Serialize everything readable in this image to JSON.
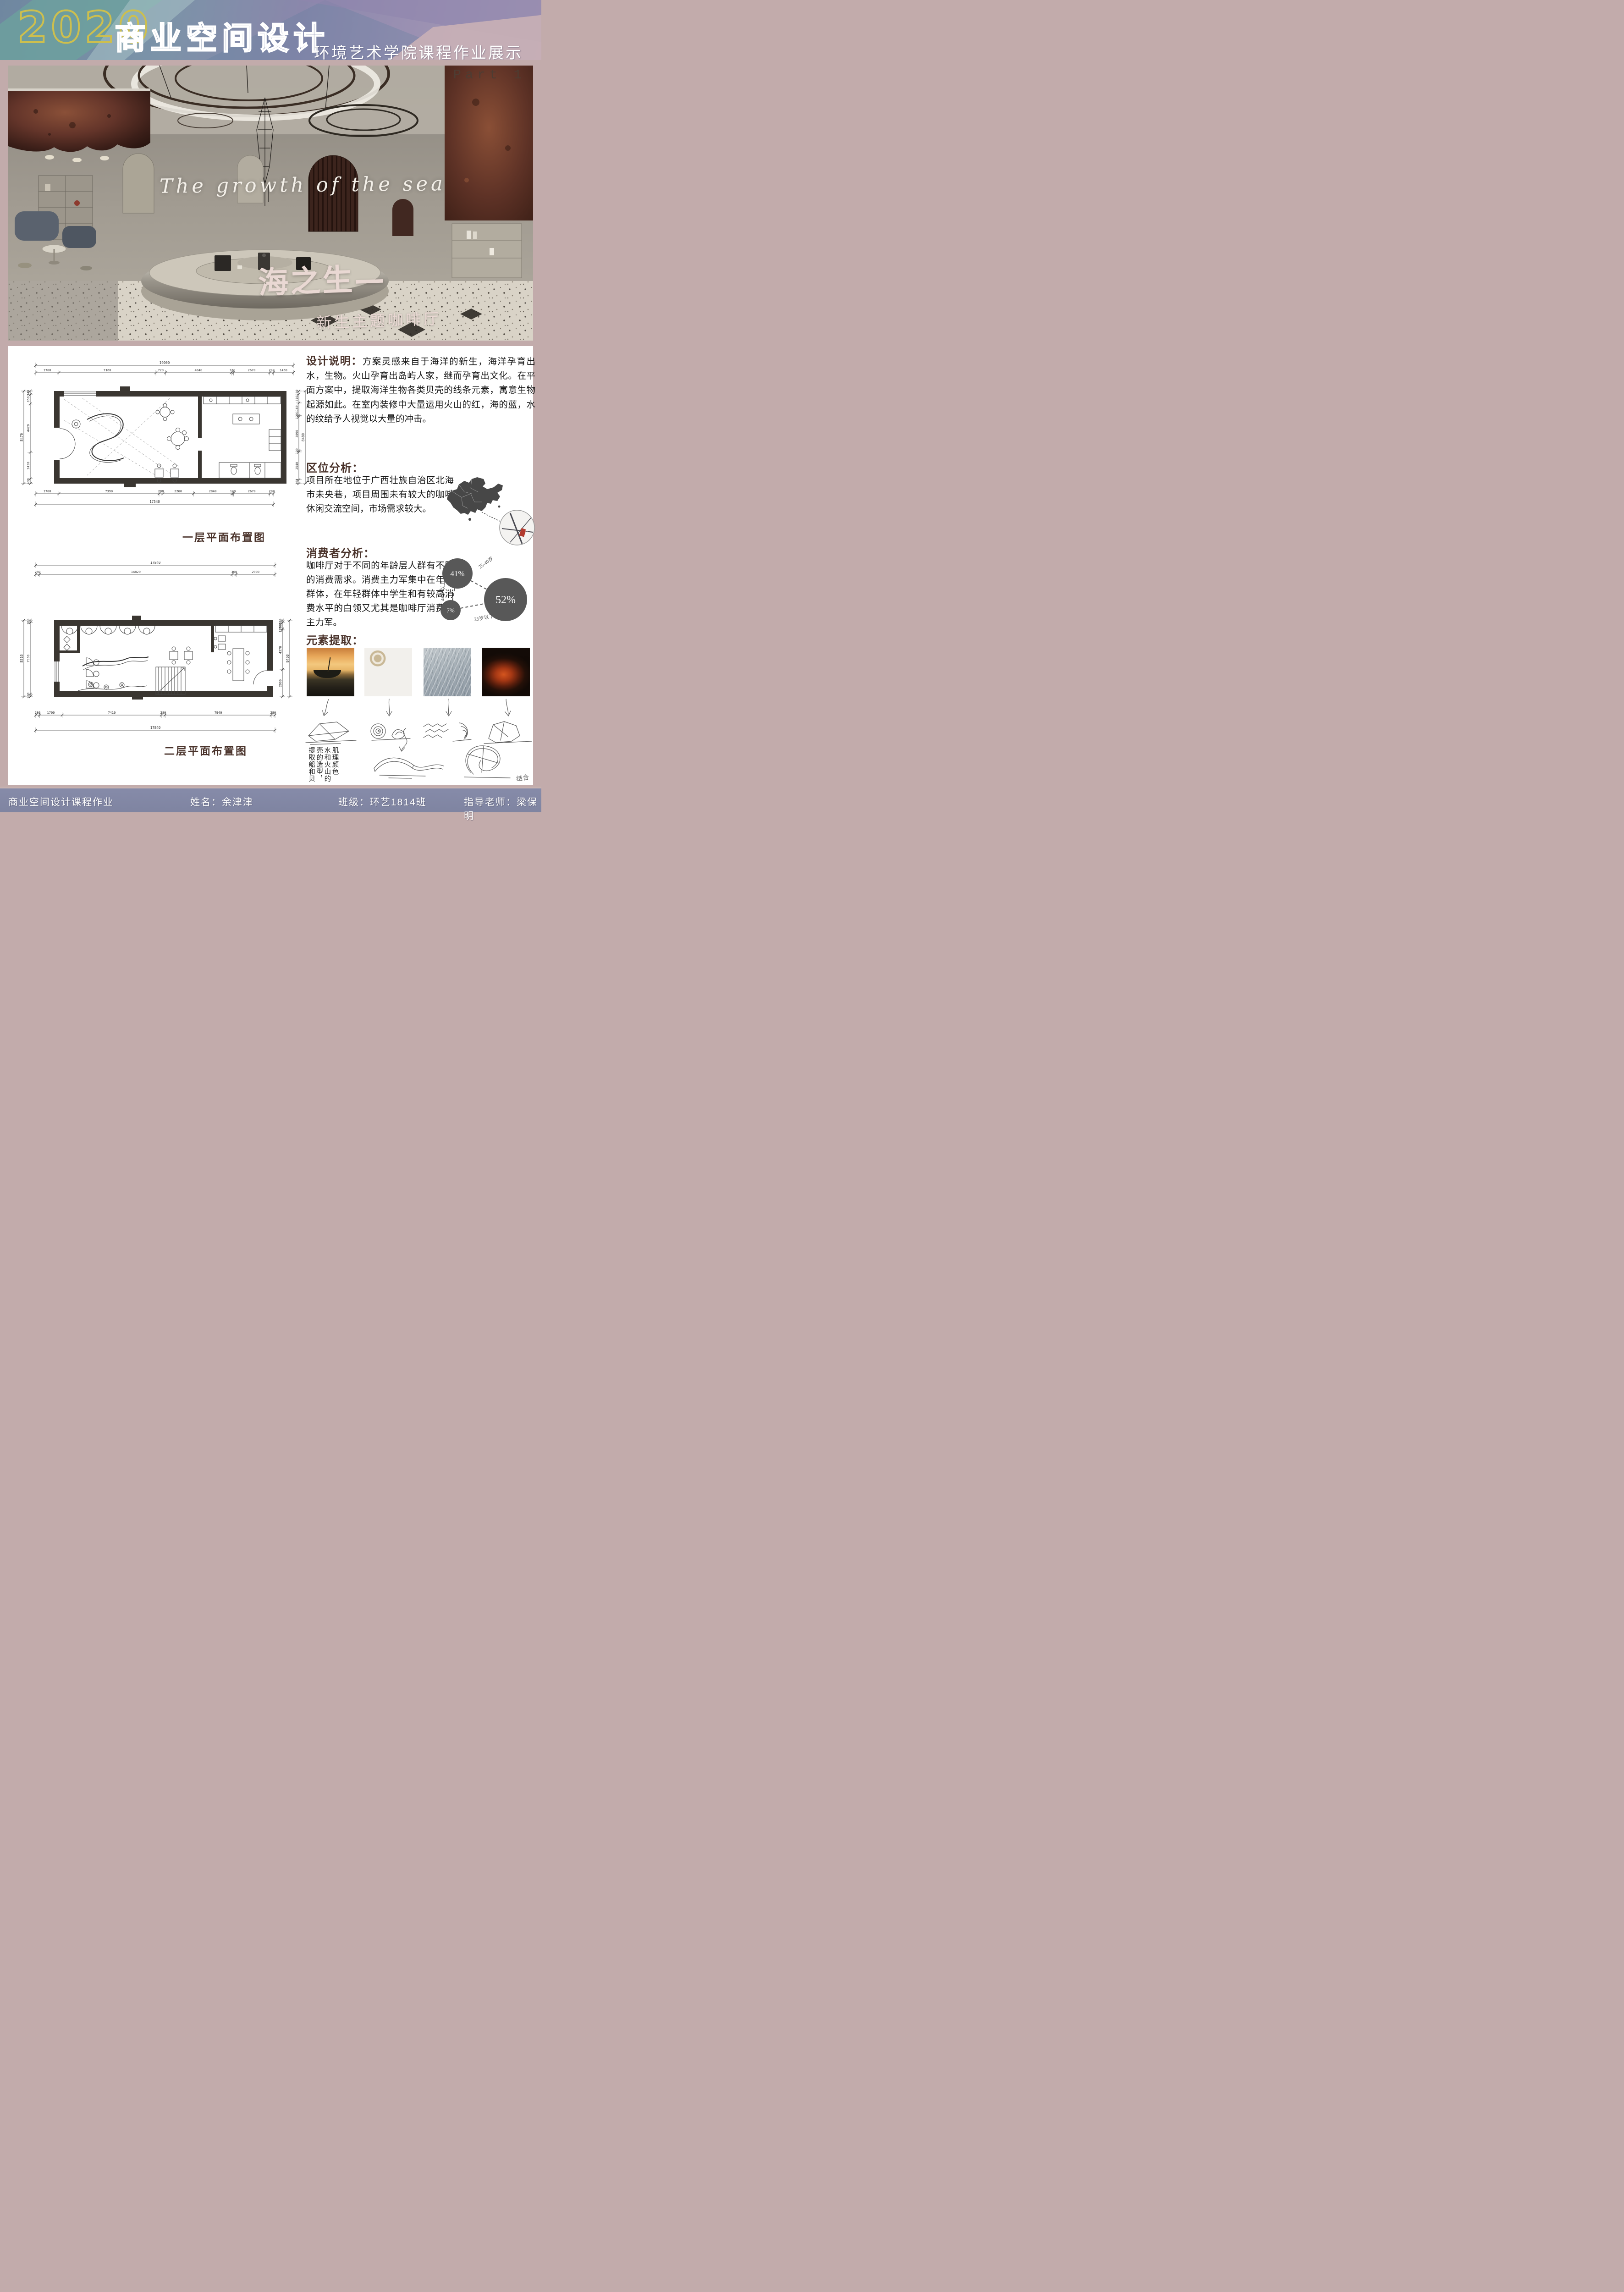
{
  "header": {
    "year": "2020",
    "title": "商业空间设计",
    "subtitle": "环境艺术学院课程作业展示",
    "part": "Part 1"
  },
  "hero": {
    "english_title": "The growth of the sea",
    "cn_title": "海之生—",
    "cn_subtitle": "新生主题咖啡厅"
  },
  "sections": {
    "design": {
      "heading": "设计说明：",
      "body": "方案灵感来自于海洋的新生，海洋孕育出水，生物。火山孕育出岛屿人家，继而孕育出文化。在平面方案中，提取海洋生物各类贝壳的线条元素，寓意生物起源如此。在室内装修中大量运用火山的红，海的蓝，水的纹给予人视觉以大量的冲击。"
    },
    "location": {
      "heading": "区位分析：",
      "body": "项目所在地位于广西壮族自治区北海市未央巷，项目周围未有较大的咖啡休闲交流空间，市场需求较大。",
      "map_label": "SITE"
    },
    "consumer": {
      "heading": "消费者分析：",
      "body": "咖啡厅对于不同的年龄层人群有不同的消费需求。消费主力军集中在年轻群体，在年轻群体中学生和有较高消费水平的白领又尤其是咖啡厅消费的主力军。",
      "bubbles": [
        {
          "value": "41%",
          "label": "25-40岁"
        },
        {
          "value": "52%",
          "label": "25岁以下"
        },
        {
          "value": "7%",
          "label": "40岁以上"
        }
      ]
    },
    "elements": {
      "heading": "元素提取：",
      "images": [
        {
          "name": "sunset-fishing-boat"
        },
        {
          "name": "seashells"
        },
        {
          "name": "water-ripples"
        },
        {
          "name": "volcano-lava"
        }
      ],
      "note_vertical": "提取船和贝壳的造型，水和火山的肌理颜色",
      "combine_label": "结合"
    }
  },
  "plans": {
    "plan1": {
      "label": "一层平面布置图",
      "top": {
        "total": "19000",
        "segments": [
          "1700",
          "7160",
          "720",
          "4840",
          "170",
          "2670",
          "280",
          "1460"
        ]
      },
      "bottom": {
        "total": "17540",
        "segments": [
          "1700",
          "7390",
          "280",
          "2260",
          "2840",
          "120",
          "2670",
          "280"
        ]
      },
      "left": {
        "total": "8470",
        "segments": [
          "340",
          "850",
          "4420",
          "2430",
          "430"
        ]
      },
      "right": {
        "total": "8480",
        "segments": [
          "280",
          "810",
          "1160",
          "120",
          "3090",
          "120",
          "2540",
          "360"
        ]
      }
    },
    "plan2": {
      "label": "二层平面布置图",
      "top": {
        "total": "17840",
        "segments": [
          "280",
          "14820",
          "300",
          "2990"
        ]
      },
      "bottom": {
        "total": "17840",
        "segments": [
          "280",
          "1700",
          "7410",
          "280",
          "7940",
          "280"
        ]
      },
      "left": {
        "total": "8510",
        "segments": [
          "280",
          "7950",
          "280"
        ]
      },
      "right": {
        "total": "8460",
        "segments": [
          "280",
          "700",
          "120",
          "4370",
          "2990"
        ]
      }
    }
  },
  "footer": {
    "course": "商业空间设计课程作业",
    "name": "姓名：余津津",
    "class": "班级：环艺1814班",
    "teacher": "指导老师：梁保明"
  },
  "colors": {
    "title_yellow": "#cdbf4e",
    "heading_brown": "#4a332b",
    "page_pink": "#c2abab",
    "footer_bg": "#8287a4",
    "bubble_gray": "#585858",
    "map_gray": "#474747",
    "site_red": "#b23a2e"
  }
}
